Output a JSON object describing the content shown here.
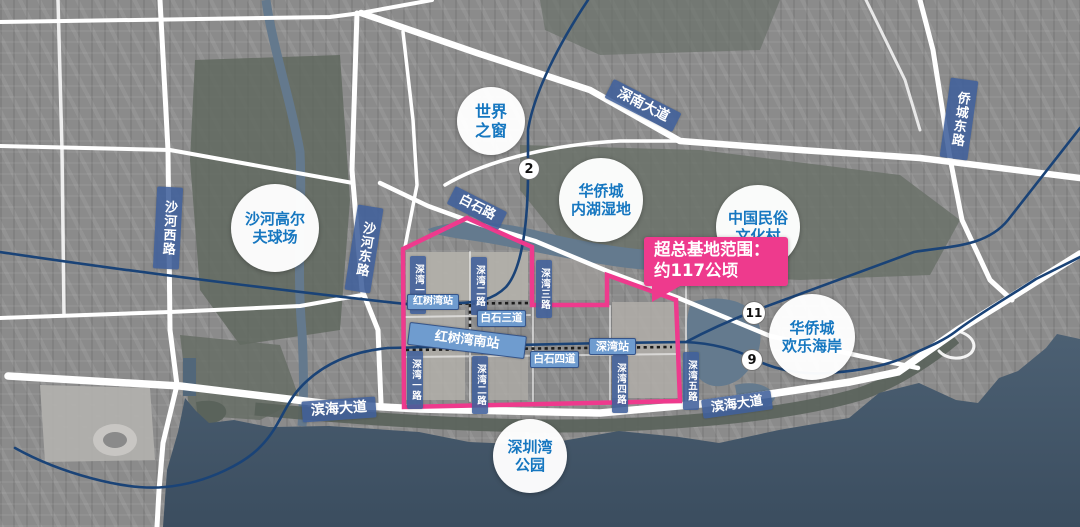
{
  "map_title": "深圳湾超级总部基地区位示意图",
  "callout": {
    "line1": "超总基地范围：",
    "line2": "约117公顷"
  },
  "places": [
    {
      "name": "window-of-the-world",
      "line1": "世界",
      "line2": "之窗"
    },
    {
      "name": "shahe-golf-course",
      "line1": "沙河高尔",
      "line2": "夫球场"
    },
    {
      "name": "oct-inner-lake-wetland",
      "line1": "华侨城",
      "line2": "内湖湿地"
    },
    {
      "name": "china-folk-culture-village",
      "line1": "中国民俗",
      "line2": "文化村"
    },
    {
      "name": "oct-happy-coast",
      "line1": "华侨城",
      "line2": "欢乐海岸"
    },
    {
      "name": "shenzhen-bay-park",
      "line1": "深圳湾",
      "line2": "公园"
    }
  ],
  "roads": [
    {
      "label": "沙河西路"
    },
    {
      "label": "沙河东路"
    },
    {
      "label": "侨城东路"
    },
    {
      "label": "白石路"
    },
    {
      "label": "深南大道"
    },
    {
      "label": "滨海大道"
    },
    {
      "label": "滨海大道"
    },
    {
      "label": "深湾一路"
    },
    {
      "label": "深湾二路"
    },
    {
      "label": "深湾三路"
    },
    {
      "label": "深湾一路"
    },
    {
      "label": "深湾二路"
    },
    {
      "label": "深湾四路"
    },
    {
      "label": "深湾五路"
    },
    {
      "label": "白石三道"
    },
    {
      "label": "白石四道"
    }
  ],
  "stations": [
    {
      "label": "红树湾站"
    },
    {
      "label": "红树湾南站"
    },
    {
      "label": "深湾站"
    }
  ],
  "metro_badges": [
    {
      "line": "2"
    },
    {
      "line": "11"
    },
    {
      "line": "9"
    }
  ],
  "colors": {
    "accent_pink": "#ee3a8d",
    "road_label_blue": "#40609b",
    "station_label_blue": "#6f9ccf",
    "place_text_blue": "#1677c0",
    "metro_line_blue": "#1a4377",
    "bay_water": "#46596c",
    "lake_water": "#647a8e",
    "land_gray": "#8f8f8f"
  }
}
